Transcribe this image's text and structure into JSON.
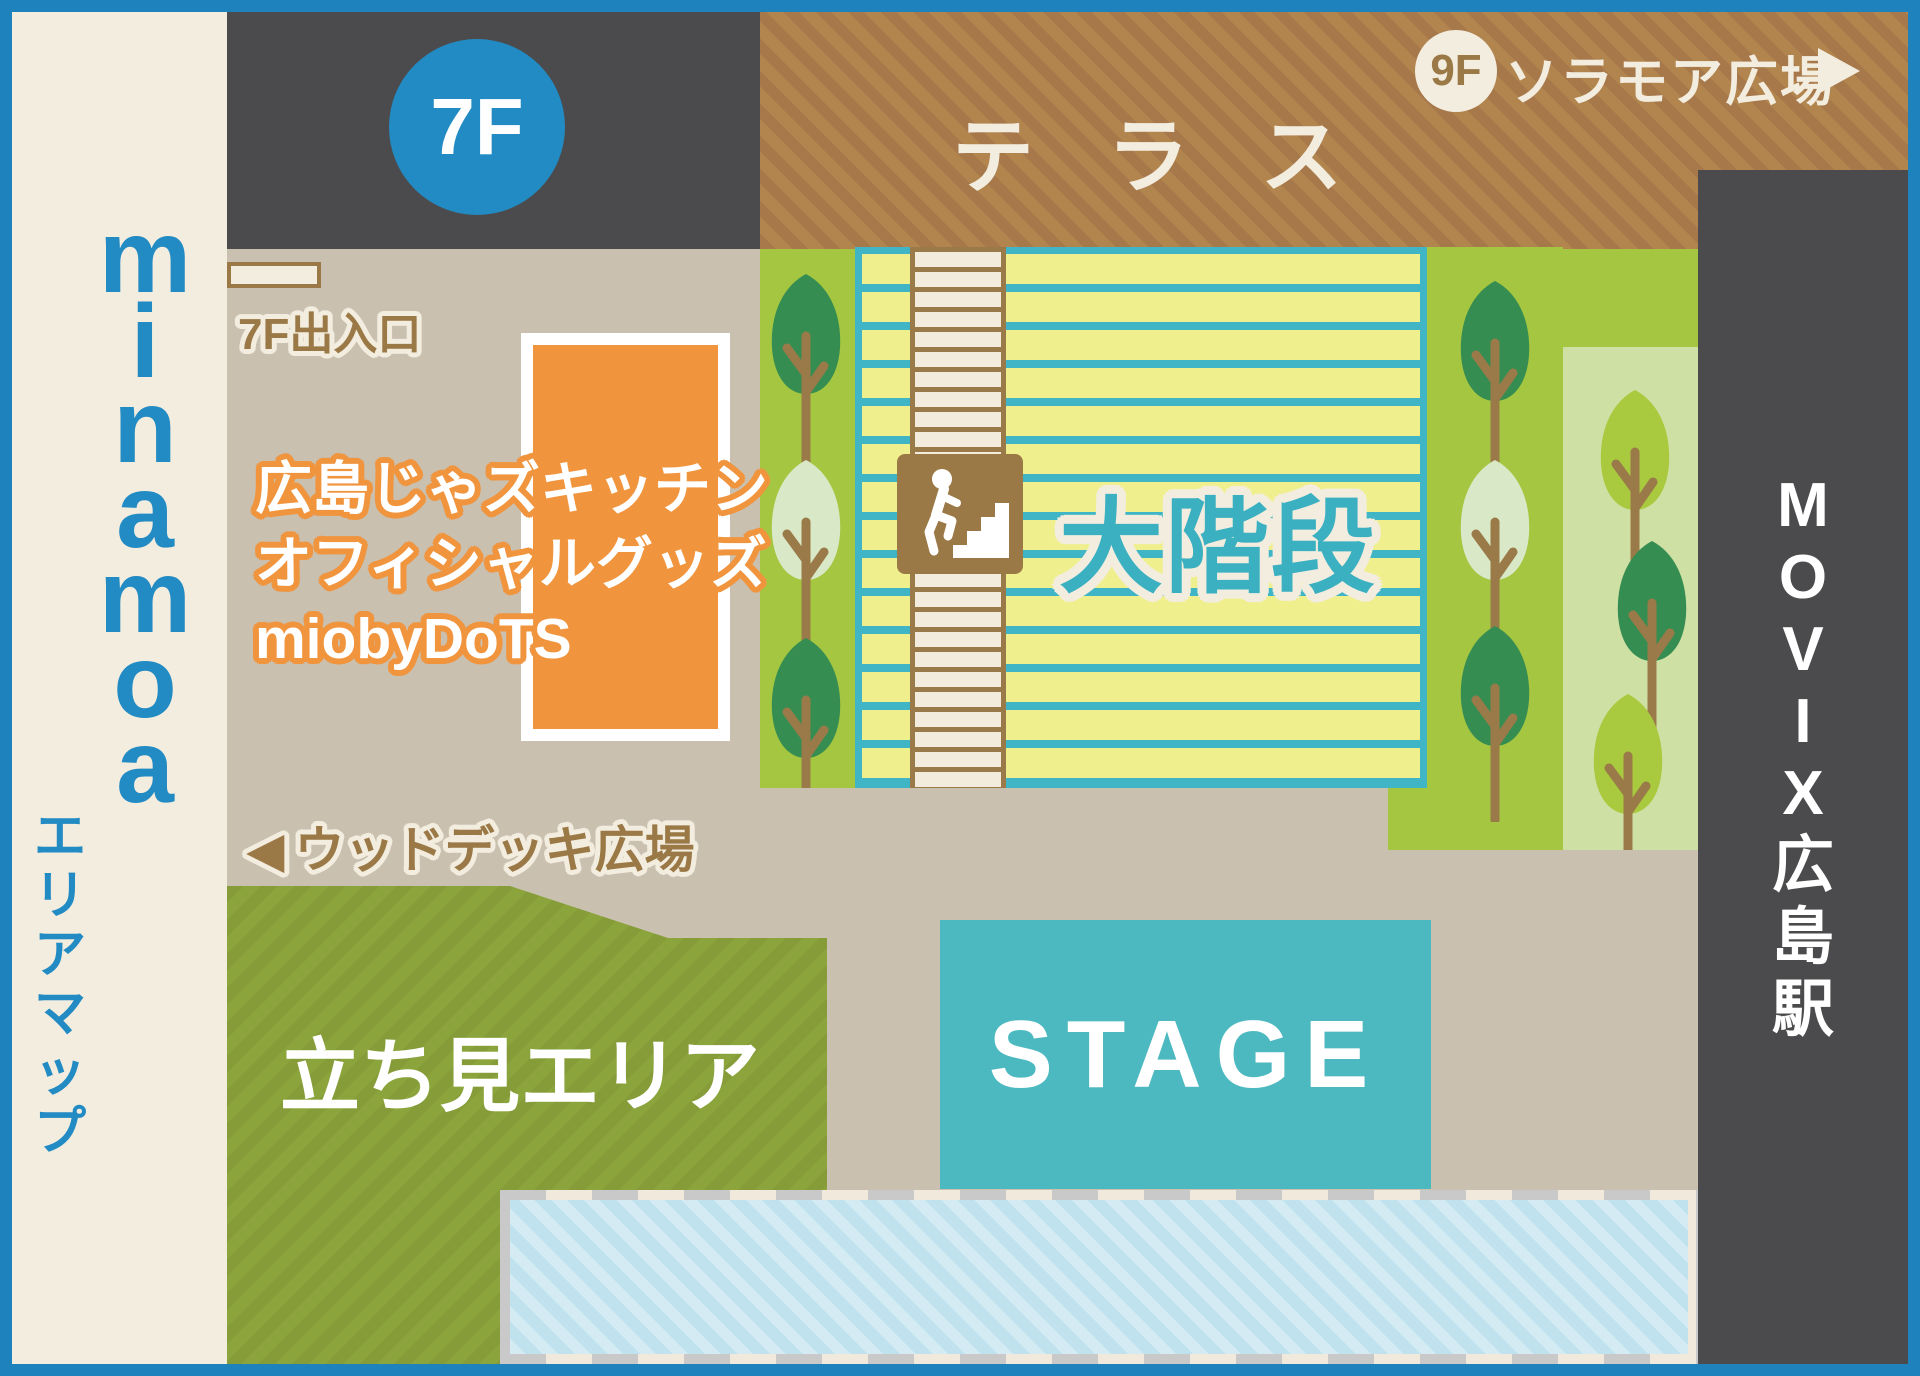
{
  "sidebar": {
    "brand": "minamoa",
    "label": "エリアマップ"
  },
  "floor_badge": "7F",
  "terrace": {
    "label": "テラス",
    "badge": "9F",
    "destination": "ソラモア広場",
    "arrow": "▶"
  },
  "entrance": {
    "label": "7F出入口"
  },
  "goods_booth": {
    "line1": "広島じゃズキッチン",
    "line2": "オフィシャルグッズ",
    "line3": "miobyDoTS"
  },
  "wood_deck": {
    "arrow": "◀",
    "label": "ウッドデッキ広場"
  },
  "grand_stairs": {
    "label": "大階段"
  },
  "standing_area": {
    "label": "立ち見エリア"
  },
  "stage": {
    "label": "STAGE"
  },
  "station": {
    "label": "MOVIX広島駅"
  },
  "icons": {
    "stairs_person": "person-climbing-stairs-icon",
    "tree": "tree-icon"
  },
  "colors": {
    "frame": "#1e82bc",
    "brand_blue": "#238bc3",
    "cream": "#f3ede0",
    "beige": "#c9c0b0",
    "dark_gray": "#4b4b4d",
    "terrace_brown": "#b2854f",
    "terrace_stripe": "#a6784a",
    "wood_brown": "#9a7946",
    "orange": "#f0953e",
    "stairs_yellow": "#f0ef8e",
    "stairs_teal": "#3fb5c5",
    "text_teal": "#3bb0c1",
    "step_cream": "#f3ecdc",
    "green_bright": "#a5c640",
    "green_pale": "#cfe0a4",
    "tree_dark": "#368d52",
    "tree_pale": "#d9e8c6",
    "tree_yg": "#a9c93f",
    "trunk": "#9a7a48",
    "standing_green": "#8ca43c",
    "standing_stripe": "#859c38",
    "stage_teal": "#4cb9c0",
    "lightblue": "#bfe2ee",
    "lightblue_stripe": "#d4ebf4",
    "dash_gray": "#c9c9c9",
    "dash_cream": "#f0e9dc"
  }
}
